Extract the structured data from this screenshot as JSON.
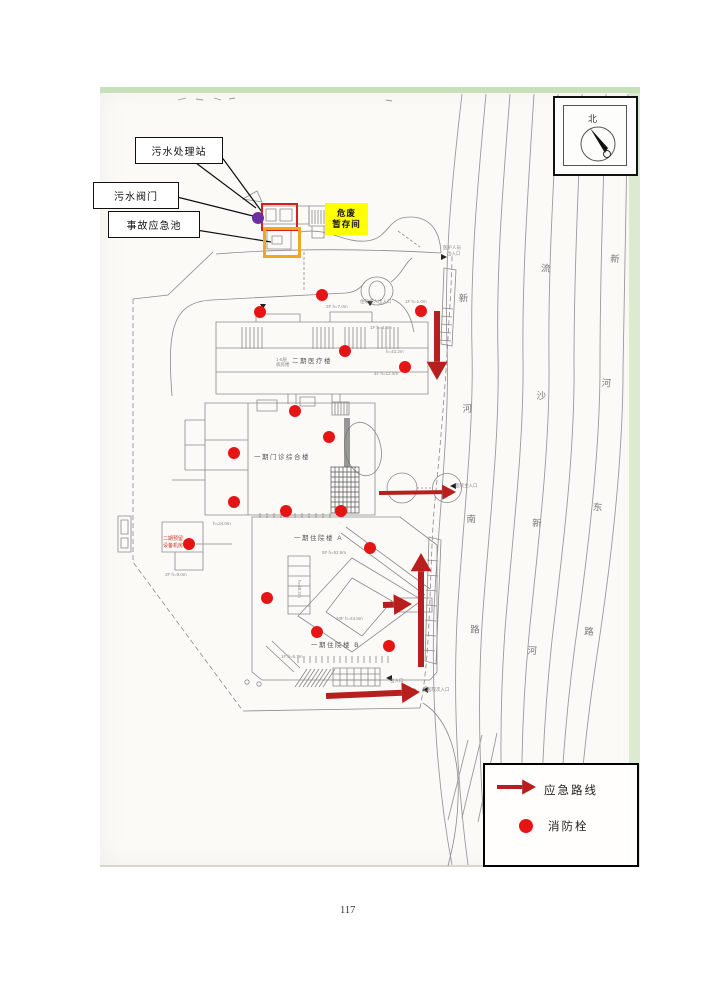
{
  "page": {
    "number": "117"
  },
  "colors": {
    "annotation_red": "#d42020",
    "arrow_red": "#b71f1f",
    "hydrant_red": "#e51515",
    "hazard_yellow": "#ffff00",
    "pool_orange": "#f2a71e",
    "valve_purple": "#6b2fa0"
  },
  "callouts": {
    "sewage_station": "污水处理站",
    "sewage_valve": "污水阀门",
    "emergency_pool": "事故应急池"
  },
  "hazard_store": {
    "line1": "危废",
    "line2": "暂存间"
  },
  "compass": {
    "north": "北"
  },
  "buildings": {
    "medical2": "二期医疗楼",
    "outpatient1": "一期门诊综合楼",
    "inpatient_a": "一期住院楼 A",
    "inpatient_b": "一期住院楼 B",
    "reserved_line1": "二期预留",
    "reserved_line2": "设备机房"
  },
  "roads": {
    "xinhe_south": "新河南路",
    "liusha_xinhe": "流沙新河",
    "xinhe_east": "新河东路"
  },
  "legend": {
    "route": "应急路线",
    "hydrant": "消防栓"
  },
  "map_data": {
    "hydrant_radius": 6,
    "hydrants": [
      [
        322,
        295
      ],
      [
        260,
        312
      ],
      [
        421,
        311
      ],
      [
        345,
        351
      ],
      [
        405,
        367
      ],
      [
        295,
        411
      ],
      [
        329,
        437
      ],
      [
        234,
        453
      ],
      [
        234,
        502
      ],
      [
        286,
        511
      ],
      [
        341,
        511
      ],
      [
        189,
        544
      ],
      [
        370,
        548
      ],
      [
        267,
        598
      ],
      [
        317,
        632
      ],
      [
        389,
        646
      ]
    ],
    "arrows": [
      {
        "x1": 437,
        "y1": 311,
        "x2": 437,
        "y2": 380,
        "w": 6
      },
      {
        "x1": 379,
        "y1": 493,
        "x2": 456,
        "y2": 492,
        "w": 4
      },
      {
        "x1": 383,
        "y1": 605,
        "x2": 412,
        "y2": 604,
        "w": 6
      },
      {
        "x1": 421,
        "y1": 667,
        "x2": 421,
        "y2": 553,
        "w": 6
      },
      {
        "x1": 326,
        "y1": 696,
        "x2": 420,
        "y2": 692,
        "w": 6
      }
    ],
    "legend_arrow": {
      "x1": 497,
      "y1": 787,
      "x2": 536,
      "y2": 787,
      "w": 4
    },
    "tiny_labels": [
      {
        "x": 443,
        "y": 245,
        "t": "医护人员"
      },
      {
        "x": 447,
        "y": 251,
        "t": "出入口"
      },
      {
        "x": 360,
        "y": 299,
        "t": "住院病人出入口"
      },
      {
        "x": 405,
        "y": 299,
        "t": "1F h=1.0m"
      },
      {
        "x": 326,
        "y": 304,
        "t": "2F h=7.0m"
      },
      {
        "x": 370,
        "y": 325,
        "t": "1F h=4.5m"
      },
      {
        "x": 386,
        "y": 349,
        "t": "h=43.2m"
      },
      {
        "x": 374,
        "y": 371,
        "t": "4F h=12.4m"
      },
      {
        "x": 276,
        "y": 357,
        "t": "1-5层"
      },
      {
        "x": 276,
        "y": 362,
        "t": "病房楼"
      },
      {
        "x": 213,
        "y": 521,
        "t": "h=24.0m"
      },
      {
        "x": 165,
        "y": 572,
        "t": "2F h=9.0m"
      },
      {
        "x": 322,
        "y": 550,
        "t": "5F h=52.6m"
      },
      {
        "x": 297,
        "y": 580,
        "t": "h=48.2m",
        "vert": true
      },
      {
        "x": 336,
        "y": 616,
        "t": "10F h=44.8m"
      },
      {
        "x": 281,
        "y": 654,
        "t": "1F h=6.7m"
      },
      {
        "x": 390,
        "y": 678,
        "t": "出入口"
      },
      {
        "x": 427,
        "y": 687,
        "t": "医院次入口"
      },
      {
        "x": 455,
        "y": 483,
        "t": "医院主入口"
      }
    ]
  }
}
